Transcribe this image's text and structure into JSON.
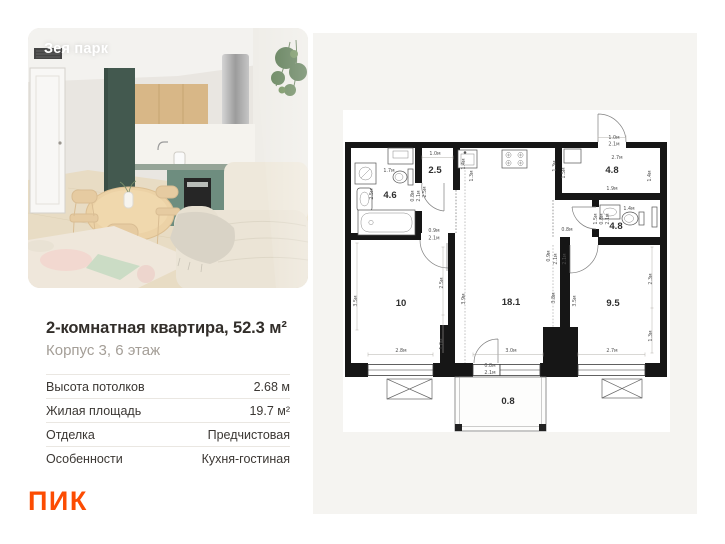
{
  "photo": {
    "overlay_title": "Зея парк"
  },
  "listing": {
    "title": "2-комнатная квартира, 52.3 м²",
    "subtitle": "Корпус 3, 6 этаж",
    "specs": [
      {
        "label": "Высота потолков",
        "value": "2.68 м"
      },
      {
        "label": "Жилая площадь",
        "value": "19.7 м²"
      },
      {
        "label": "Отделка",
        "value": "Предчистовая"
      },
      {
        "label": "Особенности",
        "value": "Кухня-гостиная"
      }
    ],
    "brand_logo": "ПИК",
    "brand_color": "#FC4C02"
  },
  "floor_plan": {
    "rooms": [
      {
        "name": "bathroom",
        "area": "4.6",
        "x": 77,
        "y": 165
      },
      {
        "name": "hallway",
        "area": "2.5",
        "x": 122,
        "y": 140
      },
      {
        "name": "entry-hall",
        "area": "4.8",
        "x": 299,
        "y": 140
      },
      {
        "name": "bathroom-2",
        "area": "4.8",
        "x": 303,
        "y": 196
      },
      {
        "name": "bedroom",
        "area": "10",
        "x": 88,
        "y": 273
      },
      {
        "name": "living-kitchen",
        "area": "18.1",
        "x": 198,
        "y": 272
      },
      {
        "name": "bedroom-2",
        "area": "9.5",
        "x": 300,
        "y": 273
      },
      {
        "name": "balcony",
        "area": "0.8",
        "x": 195,
        "y": 371
      }
    ],
    "dimensions": [
      {
        "t": "1.0м",
        "x": 122,
        "y": 122
      },
      {
        "t": "1.7м",
        "x": 76,
        "y": 139
      },
      {
        "t": "1.0м",
        "x": 301,
        "y": 106
      },
      {
        "t": "2.1м",
        "x": 301,
        "y": 112.5
      },
      {
        "t": "2.7м",
        "x": 304,
        "y": 126
      },
      {
        "t": "1.9м",
        "x": 299,
        "y": 157
      },
      {
        "t": "1.4м",
        "x": 316,
        "y": 177
      },
      {
        "t": "0.8м",
        "x": 254,
        "y": 198
      },
      {
        "t": "0.9м",
        "x": 121,
        "y": 199
      },
      {
        "t": "2.1м",
        "x": 121,
        "y": 206.5
      },
      {
        "t": "2.8м",
        "x": 88,
        "y": 319
      },
      {
        "t": "3.0м",
        "x": 198,
        "y": 319
      },
      {
        "t": "0.8м",
        "x": 177,
        "y": 334
      },
      {
        "t": "2.1м",
        "x": 177,
        "y": 341
      },
      {
        "t": "2.7м",
        "x": 299,
        "y": 319
      },
      {
        "t": "2.5м",
        "x": 60,
        "y": 161,
        "r": -90
      },
      {
        "t": "0.8м",
        "x": 101,
        "y": 163,
        "r": -90
      },
      {
        "t": "2.1м",
        "x": 107,
        "y": 163,
        "r": -90
      },
      {
        "t": "2.5м",
        "x": 113,
        "y": 159,
        "r": -90
      },
      {
        "t": "1.4м",
        "x": 152,
        "y": 131,
        "r": -90
      },
      {
        "t": "1.3м",
        "x": 160,
        "y": 143,
        "r": -90
      },
      {
        "t": "1.3м",
        "x": 243,
        "y": 133,
        "r": -90
      },
      {
        "t": "1.5м",
        "x": 252,
        "y": 140,
        "r": -90
      },
      {
        "t": "1.4м",
        "x": 338,
        "y": 143,
        "r": -90
      },
      {
        "t": "1.5м",
        "x": 284,
        "y": 186,
        "r": -90
      },
      {
        "t": "0.8м",
        "x": 290,
        "y": 186,
        "r": -90
      },
      {
        "t": "2.1м",
        "x": 296,
        "y": 186,
        "r": -90
      },
      {
        "t": "3.5м",
        "x": 44,
        "y": 268,
        "r": -90
      },
      {
        "t": "2.5м",
        "x": 130,
        "y": 250,
        "r": -90
      },
      {
        "t": "1.0м",
        "x": 130,
        "y": 311,
        "r": -90
      },
      {
        "t": "3.9м",
        "x": 152,
        "y": 266,
        "r": -90
      },
      {
        "t": "3.8м",
        "x": 242,
        "y": 265,
        "r": -90
      },
      {
        "t": "0.9м",
        "x": 237,
        "y": 223,
        "r": -90
      },
      {
        "t": "2.1м",
        "x": 244,
        "y": 226,
        "r": -90
      },
      {
        "t": "2.1м",
        "x": 253,
        "y": 226,
        "r": -90
      },
      {
        "t": "3.5м",
        "x": 263,
        "y": 268,
        "r": -90
      },
      {
        "t": "2.3м",
        "x": 339,
        "y": 246,
        "r": -90
      },
      {
        "t": "1.3м",
        "x": 339,
        "y": 303,
        "r": -90
      }
    ]
  }
}
